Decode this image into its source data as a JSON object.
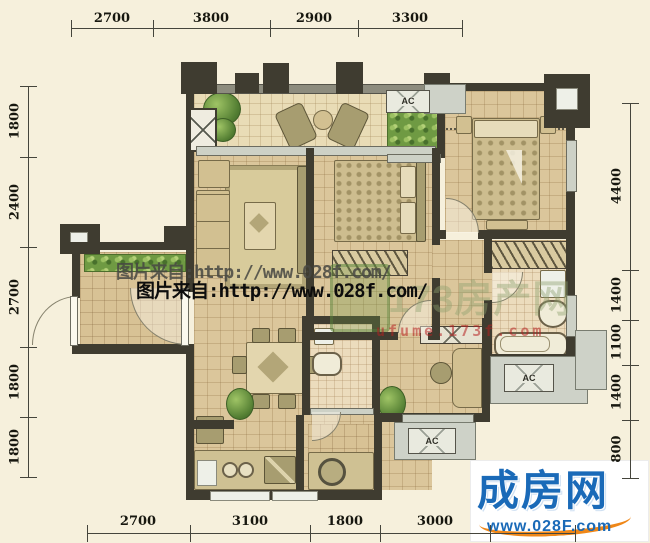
{
  "dimensions": {
    "top": [
      "2700",
      "3800",
      "2900",
      "3300"
    ],
    "bottom": [
      "2700",
      "3100",
      "1800",
      "3000"
    ],
    "left": [
      "1800",
      "2400",
      "2700",
      "1800",
      "1800"
    ],
    "right": [
      "4400",
      "1400",
      "1100",
      "1400",
      "800"
    ]
  },
  "labels": {
    "ac": "AC"
  },
  "watermarks": {
    "credit_gray": "图片来自:http://www.028f.com/",
    "credit_black": "图片来自:http://www.028f.com/",
    "brand_faint": "173房产网",
    "brand_faint_url": "ufume.173f.com"
  },
  "logo": {
    "title": "成房网",
    "url": "www.028F.com"
  }
}
